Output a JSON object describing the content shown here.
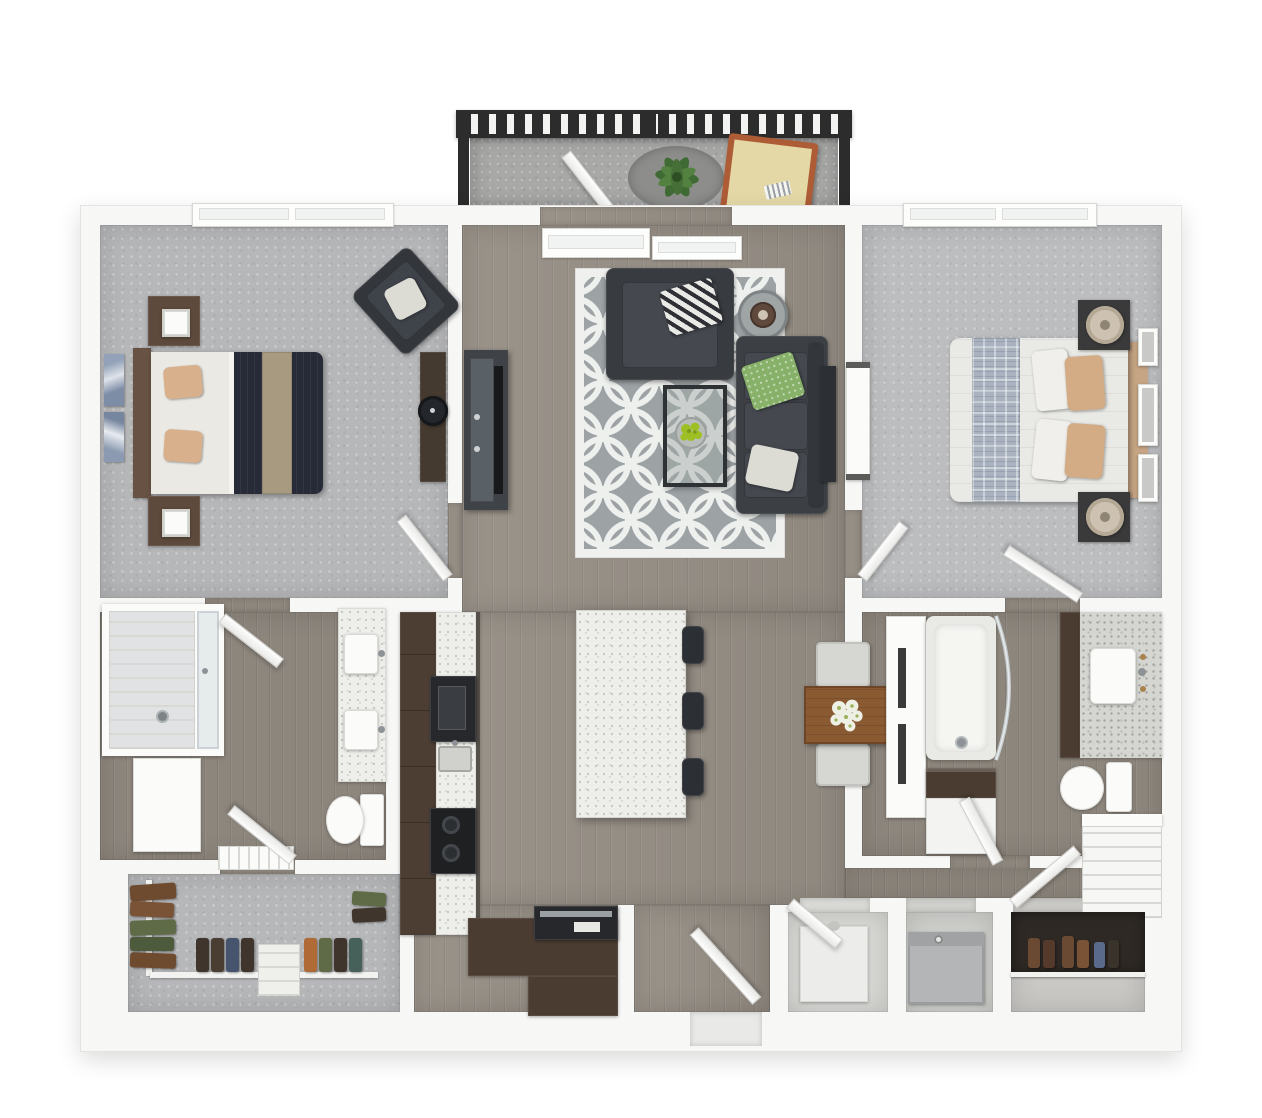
{
  "meta": {
    "title": "2 Bedroom / 2 Bath Apartment — 3D Top-Down Floor Plan",
    "style": "photoreal 3D render, white background, no text labels"
  },
  "palette": {
    "background": "#ffffff",
    "wall": "#f7f7f6",
    "wood_floor": "#989188",
    "carpet": "#b6b7b9",
    "concrete": "#a8a8a7",
    "counter_speckle": "#eeeeea",
    "granite": "#d5d5d1",
    "cabinet_brown": "#4c3e33",
    "sofa_charcoal": "#3c3f44",
    "accent_green": "#87b169",
    "navy_bedding": "#272b37",
    "tan_bedding": "#d8b18c",
    "dining_wood": "#8a5a33",
    "railing_dark": "#2c2c2c",
    "terracotta": "#ad5c36"
  },
  "rooms": {
    "balcony": {
      "label": "Balcony",
      "furniture": [
        "railing",
        "round outdoor rug",
        "potted plant",
        "terracotta chaise lounge",
        "open slider door"
      ]
    },
    "bedroom1": {
      "label": "Bedroom 1",
      "furniture": [
        "window",
        "queen bed with navy duvet and tan runner",
        "2 nightstands with lamps",
        "wall art",
        "dark accent chair",
        "dresser with round mirror"
      ]
    },
    "living": {
      "label": "Living Room",
      "furniture": [
        "sliding balcony door",
        "quatrefoil area rug",
        "charcoal armchair with chevron pillow",
        "round side table with bowl",
        "charcoal sofa with green and white pillows",
        "sofa-back console",
        "glass coffee table with green centerpiece",
        "media console with tv"
      ]
    },
    "bedroom2": {
      "label": "Bedroom 2",
      "furniture": [
        "window",
        "queen bed with plaid runner and tan pillows",
        "2 nightstands with round lamps",
        "3 gallery frames",
        "wardrobe panel"
      ]
    },
    "bathroom1": {
      "label": "Bathroom 1",
      "furniture": [
        "glass walk-in shower",
        "double-sink vanity",
        "toilet",
        "striped bath mat"
      ]
    },
    "closet1": {
      "label": "Walk-in Closet",
      "furniture": [
        "hanging clothes",
        "white rods and shelf"
      ]
    },
    "kitchen": {
      "label": "Kitchen",
      "furniture": [
        "brown cabinet run",
        "speckled counter",
        "wall oven",
        "black cooktop",
        "sink",
        "island with 3 barstools",
        "entry console with appliance"
      ]
    },
    "dining": {
      "label": "Dining Area",
      "furniture": [
        "wood table with flower centerpiece",
        "2 upholstered chairs"
      ]
    },
    "bathroom2": {
      "label": "Bathroom 2",
      "furniture": [
        "white linen cabinet",
        "bathtub with curved glass screen",
        "dark wood shelf",
        "granite vanity with sink",
        "tall brown cabinet",
        "toilet",
        "white shelving unit"
      ]
    },
    "entry": {
      "label": "Entry Hall",
      "furniture": [
        "front door"
      ]
    },
    "utility": {
      "label": "Utility Closet",
      "furniture": [
        "water heater"
      ]
    },
    "laundry": {
      "label": "Laundry Closet",
      "furniture": [
        "washer/dryer unit"
      ]
    },
    "shoes": {
      "label": "Shoe Closet",
      "furniture": [
        "boots and shoes",
        "shelf"
      ]
    }
  }
}
